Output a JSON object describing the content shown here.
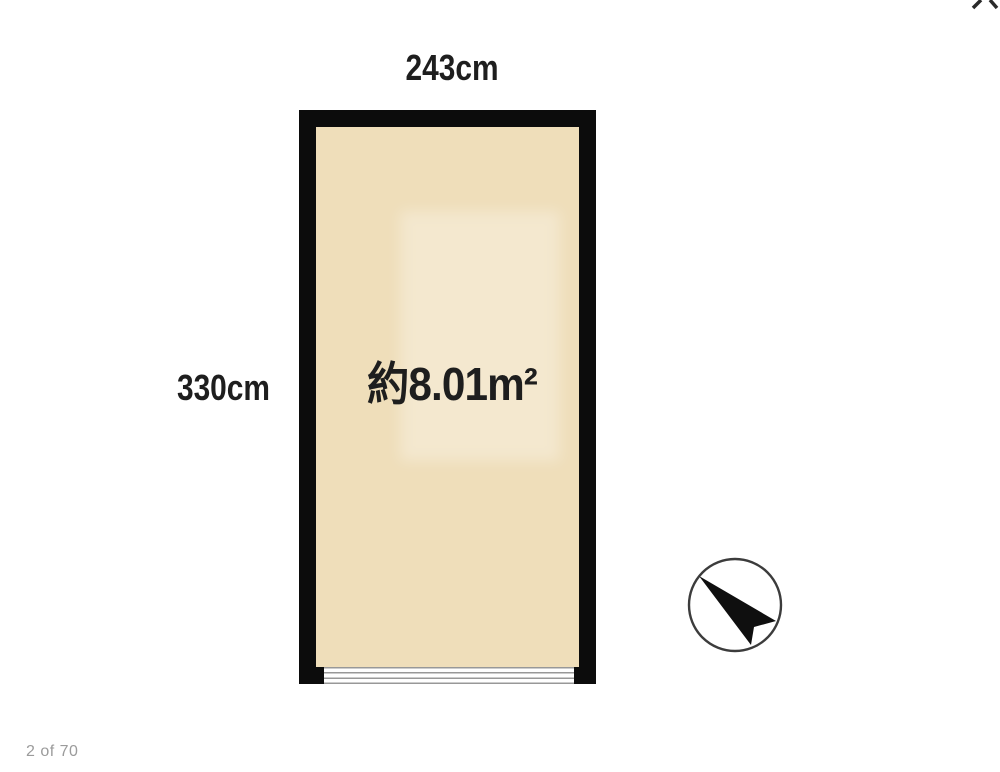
{
  "page": {
    "background": "#ffffff",
    "pagination": "2 of 70"
  },
  "floorplan": {
    "width_dimension": "243cm",
    "height_dimension": "330cm",
    "area_label": "約8.01m²",
    "colors": {
      "wall": "#0c0c0c",
      "floor": "#efdeba",
      "floor_highlight": "rgba(255,255,255,0.30)",
      "window_lines": "#989898",
      "dimension_text": "#1e1e1e",
      "pagination_text": "#9b9b9b",
      "fragment_ink": "#2a2a2a"
    },
    "compass": {
      "icon": "north-arrow",
      "circle_stroke": "#3c3c3c",
      "needle_fill": "#0f0f0f"
    }
  }
}
